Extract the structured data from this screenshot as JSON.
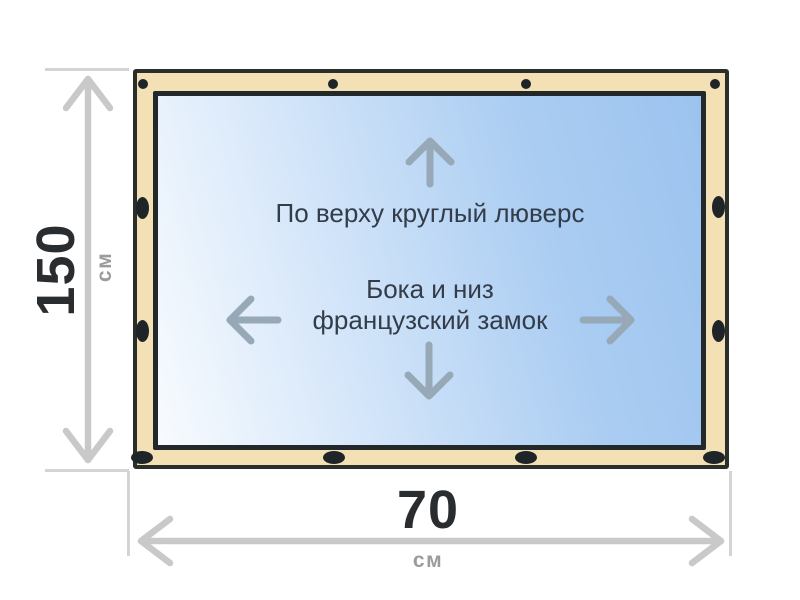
{
  "notes": {
    "top": "По верху круглый люверс",
    "middle1": "Бока и низ",
    "middle2": "французский замок"
  },
  "dims": {
    "height": {
      "value": "150",
      "unit": "см"
    },
    "width": {
      "value": "70",
      "unit": "см"
    }
  },
  "icons": {
    "top_edge": "round-grommet-icon",
    "sides_bottom": "french-lock-icon",
    "panel_arrows": [
      "up-arrow-icon",
      "down-arrow-icon",
      "left-arrow-icon",
      "right-arrow-icon"
    ],
    "dimension_arrows": [
      "vertical-dimension-arrow-icon",
      "horizontal-dimension-arrow-icon"
    ]
  },
  "colors": {
    "frame_fill": "#F3E1B5",
    "frame_border": "#2B2F2B",
    "panel_border": "#23282A",
    "panel_grad_start": "#F8FBFE",
    "panel_grad_end": "#9CC3EF",
    "grommet": "#1F2428",
    "dim_line": "#C9C9C9",
    "ext_line": "#D4D4D4",
    "dim_number": "#2A2D30",
    "dim_unit": "#9B9B9B",
    "note_text": "#333C49",
    "panel_arrow": "#97A8B6",
    "background": "#FFFFFF"
  }
}
